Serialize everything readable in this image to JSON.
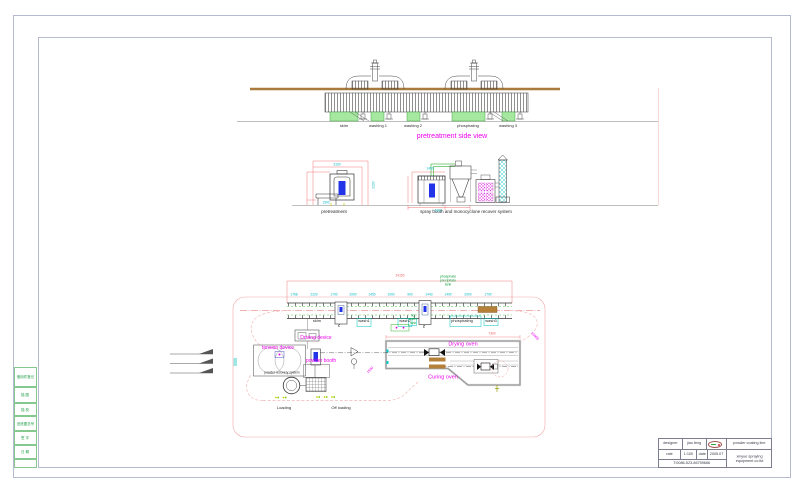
{
  "side_view": {
    "title": "pretreatment side view",
    "tank_labels": [
      "skim",
      "washing 1",
      "washing 2",
      "phosphating",
      "washing 3"
    ]
  },
  "elevations": {
    "pretreatment_label": "pretreatment",
    "spray_label": "spray booth and monocyclone recover system",
    "pretreat_dims": [
      "3100",
      "1500",
      "2200"
    ],
    "spray_dims": [
      "1450",
      "4300"
    ]
  },
  "plan": {
    "overall_dim": "24150",
    "oven_dim": "7300",
    "diag_dim_right": "15000",
    "diag_dim_mid": "1500",
    "phosphate_note": [
      "phosphate",
      "precipitate",
      "tank"
    ],
    "hot_water_note": [
      "hot",
      "water",
      "tank"
    ],
    "top_dims": [
      "1768",
      "2229",
      "1700",
      "2000",
      "1450",
      "1000",
      "900",
      "1443",
      "1400",
      "2000",
      "1700"
    ],
    "station_labels": [
      "skim",
      "wash1",
      "wash2",
      "phosphating",
      "wash3"
    ],
    "z_mark": "Z",
    "driving_label": "Driving device",
    "tension_label": "tension device",
    "powder_booth_label": "powder booth",
    "recovery_label": "powder recovery system",
    "drying_label": "Drying oven",
    "curing_label": "Curing oven",
    "loading_label": "Loading",
    "offloading_label": "Off loading"
  },
  "title_block": {
    "designer_label": "designer",
    "designer_name": "jiao feng",
    "rate_label": "rate",
    "rate_value": "1:100",
    "date_label": "date",
    "date_value": "2005.07",
    "phone": "T:0086-523-86759666",
    "product": "powder coating line",
    "company_line1": "xinyue spraying",
    "company_line2": "equipment co.ltd"
  },
  "margin_strip": {
    "rows": [
      "借用件登记",
      "描 图",
      "描 校",
      "旧底图总号",
      "签 字",
      "日 期"
    ]
  }
}
